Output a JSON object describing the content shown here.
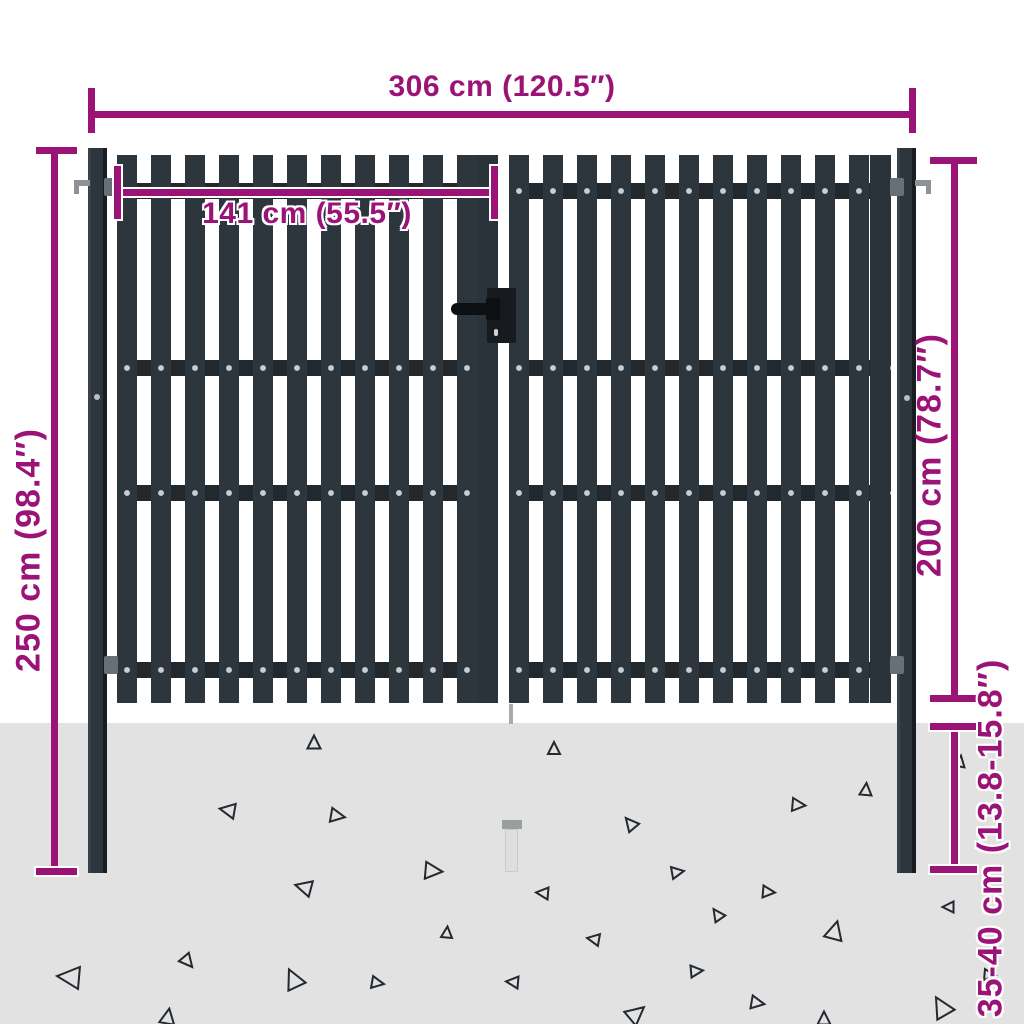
{
  "title": "Double fence gate dimension diagram",
  "dimensions": {
    "total_width": {
      "label": "306 cm (120.5″)"
    },
    "leaf_width": {
      "label": "141 cm (55.5″)"
    },
    "post_height": {
      "label": "250 cm (98.4″)"
    },
    "gate_height": {
      "label": "200 cm (78.7″)"
    },
    "buried_depth": {
      "label": "35-40 cm (13.8-15.8″)"
    }
  },
  "colors": {
    "accent": "#9b1377",
    "gate": "#2d353d",
    "rail": "#21282e",
    "rivet": "#c9ced2",
    "ground": "#e2e2e3",
    "hardware": "#0d1013",
    "triangle_stroke": "#23292e"
  },
  "decor": {
    "triangles": [
      [
        314,
        742,
        13,
        0
      ],
      [
        227,
        810,
        15,
        -80
      ],
      [
        338,
        816,
        14,
        100
      ],
      [
        303,
        887,
        16,
        -75
      ],
      [
        434,
        871,
        17,
        95
      ],
      [
        447,
        932,
        11,
        5
      ],
      [
        68,
        977,
        22,
        -85
      ],
      [
        188,
        962,
        13,
        140
      ],
      [
        293,
        978,
        19,
        -25
      ],
      [
        378,
        983,
        12,
        100
      ],
      [
        168,
        1016,
        15,
        10
      ],
      [
        554,
        748,
        12,
        0
      ],
      [
        630,
        823,
        13,
        -40
      ],
      [
        799,
        805,
        13,
        95
      ],
      [
        866,
        789,
        12,
        5
      ],
      [
        960,
        761,
        11,
        10
      ],
      [
        678,
        872,
        12,
        80
      ],
      [
        542,
        893,
        12,
        -85
      ],
      [
        769,
        892,
        12,
        95
      ],
      [
        717,
        914,
        12,
        -35
      ],
      [
        835,
        930,
        18,
        15
      ],
      [
        593,
        939,
        12,
        -80
      ],
      [
        948,
        907,
        11,
        -90
      ],
      [
        697,
        971,
        12,
        85
      ],
      [
        758,
        1003,
        13,
        100
      ],
      [
        941,
        1006,
        20,
        -30
      ],
      [
        990,
        975,
        11,
        95
      ],
      [
        637,
        1013,
        18,
        50
      ],
      [
        512,
        982,
        12,
        -85
      ],
      [
        824,
        1018,
        13,
        0
      ]
    ]
  }
}
